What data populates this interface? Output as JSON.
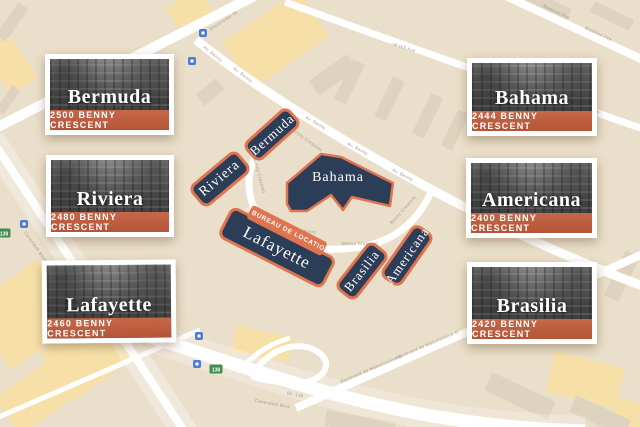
{
  "colors": {
    "map_bg": "#eadfca",
    "block_beige": "#ded3bf",
    "block_yellow": "#f7e0a8",
    "street": "#ffffff",
    "navy": "#2c3d58",
    "orange_border": "#df7450",
    "bureau_bg": "#df7450",
    "card_banner": "#c05a3a",
    "street_label": "#a39a8d",
    "transit_blue": "#4b7bd5",
    "route_green": "#3f8f4f"
  },
  "cards": [
    {
      "name": "Bermuda",
      "address": "2500 BENNY CRESCENT"
    },
    {
      "name": "Riviera",
      "address": "2480 BENNY CRESCENT"
    },
    {
      "name": "Lafayette",
      "address": "2460 BENNY CRESCENT"
    },
    {
      "name": "Bahama",
      "address": "2444 BENNY CRESCENT"
    },
    {
      "name": "Americana",
      "address": "2400 BENNY CRESCENT"
    },
    {
      "name": "Brasilia",
      "address": "2420 BENNY CRESCENT"
    }
  ],
  "map_buildings": {
    "riviera": "Riviera",
    "bermuda": "Bermuda",
    "bahama": "Bahama",
    "lafayette": "Lafayette",
    "brasilia": "Brasilia",
    "americana": "Americana"
  },
  "bureau": {
    "label": "BUREAU DE LOCATION",
    "icon": "⌂"
  },
  "street_labels": {
    "sherbrooke": "Sherbrooke St",
    "av_benny": "Av. Benny",
    "benny_crescent": "Benny Crescent",
    "madison": "Madison Ave",
    "w_hill": "W Hill Ave",
    "cavendish": "Cavendish Blvd",
    "rt138": "Rt. 138",
    "maisonneuve": "Boulevard de Maisonneuve O",
    "shield138": "138"
  }
}
